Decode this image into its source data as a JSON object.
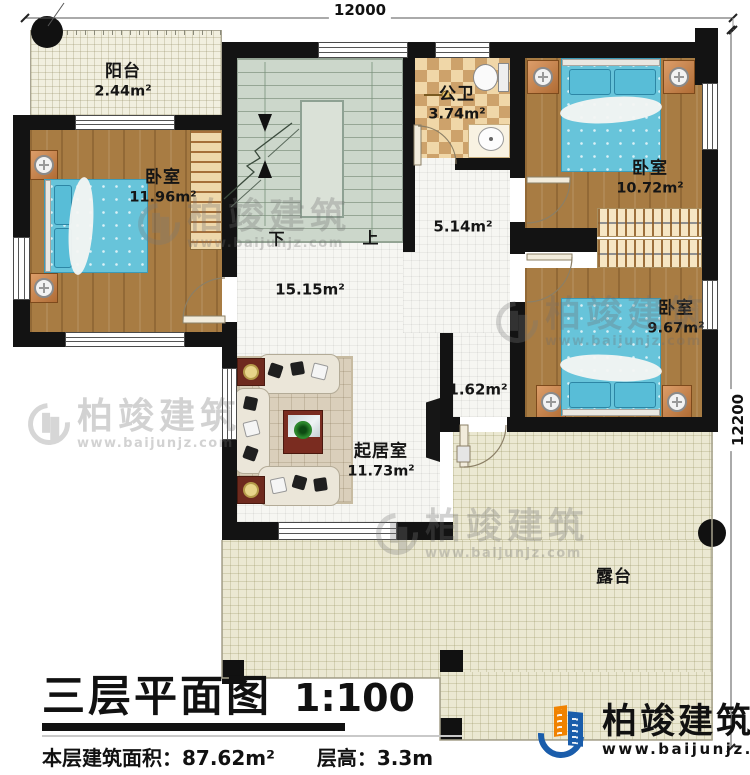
{
  "dimensions": {
    "top": "12000",
    "right": "12200"
  },
  "rooms": {
    "balcony": {
      "name": "阳台",
      "area": "2.44m²"
    },
    "bedroom_left": {
      "name": "卧室",
      "area": "11.96m²"
    },
    "bathroom": {
      "name": "公卫",
      "area": "3.74m²"
    },
    "bedroom_top_right": {
      "name": "卧室",
      "area": "10.72m²"
    },
    "bedroom_bottom_right": {
      "name": "卧室",
      "area": "9.67m²"
    },
    "living_room": {
      "name": "起居室",
      "area": "11.73m²"
    },
    "hall": {
      "area": "15.15m²"
    },
    "corridor": {
      "area": "5.14m²"
    },
    "terrace_lobby": {
      "area": "1.62m²"
    },
    "terrace": {
      "name": "露台"
    }
  },
  "stairs": {
    "down_label": "下",
    "up_label": "上"
  },
  "title_block": {
    "title": "三层平面图",
    "scale": "1:100",
    "floor_area_label": "本层建筑面积：",
    "floor_area_value": "87.62m²",
    "floor_height_label": "层高：",
    "floor_height_value": "3.3m"
  },
  "brand": {
    "name": "柏竣建筑",
    "url": "www.baijunjz.com"
  },
  "colors": {
    "wall": "#131313",
    "wood_floor": "#a87c43",
    "bed_blue": "#67c4da",
    "stair_green": "#ccd7cb",
    "terrace_cream": "#ebe8d2",
    "logo_blue": "#1a5dab",
    "logo_orange": "#f08200"
  }
}
